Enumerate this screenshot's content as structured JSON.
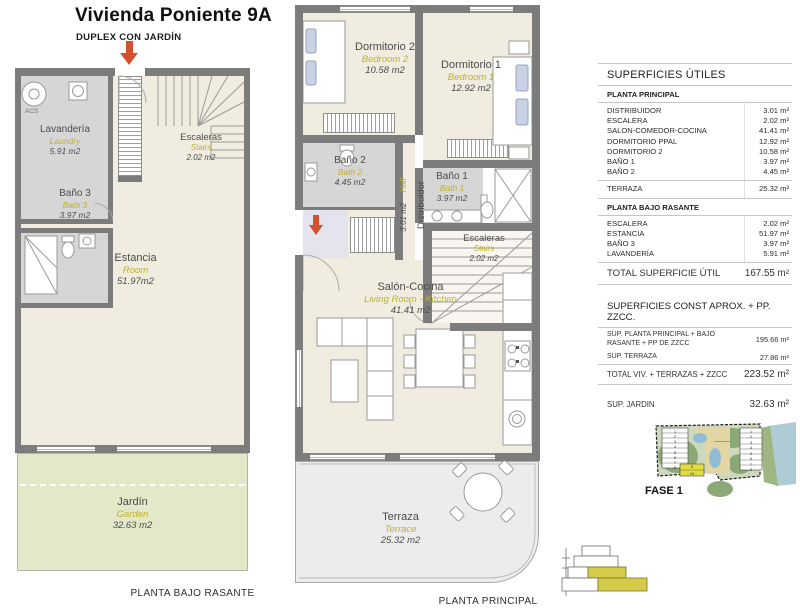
{
  "title": "Vivienda Poniente 9A",
  "subtitle": "DUPLEX CON JARDÍN",
  "plans": {
    "lower": {
      "caption": "PLANTA BAJO RASANTE",
      "acs": "ACS",
      "rooms": {
        "lavanderia": {
          "name": "Lavandería",
          "en": "Laundry",
          "area": "5.91 m2"
        },
        "escaleras": {
          "name": "Escaleras",
          "en": "Stairs",
          "area": "2.02 m2"
        },
        "bano3": {
          "name": "Baño 3",
          "en": "Bath 3",
          "area": "3.97 m2"
        },
        "estancia": {
          "name": "Estancia",
          "en": "Room",
          "area": "51.97m2"
        },
        "jardin": {
          "name": "Jardín",
          "en": "Garden",
          "area": "32.63 m2"
        }
      }
    },
    "main": {
      "caption": "PLANTA PRINCIPAL",
      "rooms": {
        "dormitorio2": {
          "name": "Dormitorio 2",
          "en": "Bedroom 2",
          "area": "10.58 m2"
        },
        "dormitorio1": {
          "name": "Dormitorio 1",
          "en": "Bedroom 1",
          "area": "12.92 m2"
        },
        "bano2": {
          "name": "Baño 2",
          "en": "Bath 2",
          "area": "4.45 m2"
        },
        "bano1": {
          "name": "Baño 1",
          "en": "Bath 1",
          "area": "3.97 m2"
        },
        "distribuidor": {
          "name": "Distribuidor",
          "en": "Hall",
          "area": "3.01 m2"
        },
        "escaleras": {
          "name": "Escaleras",
          "en": "Stairs",
          "area": "2.02 m2"
        },
        "salon": {
          "name": "Salón-Cocina",
          "en": "Living Room - Kitchen",
          "area": "41.41 m2"
        },
        "terraza": {
          "name": "Terraza",
          "en": "Terrace",
          "area": "25.32 m2"
        }
      }
    }
  },
  "surfaces_utiles": {
    "title": "SUPERFICIES ÚTILES",
    "sections": [
      {
        "heading": "PLANTA PRINCIPAL",
        "rows": [
          {
            "label": "DISTRIBUIDOR",
            "value": "3.01 m²"
          },
          {
            "label": "ESCALERA",
            "value": "2.02 m²"
          },
          {
            "label": "SALON-COMEDOR-COCINA",
            "value": "41.41 m²"
          },
          {
            "label": "DORMITORIO PPAL",
            "value": "12.92 m²"
          },
          {
            "label": "DORMITORIO 2",
            "value": "10.58 m²"
          },
          {
            "label": "BAÑO 1",
            "value": "3.97 m²"
          },
          {
            "label": "BAÑO 2",
            "value": "4.45 m²"
          }
        ],
        "terraza_row": {
          "label": "TERRAZA",
          "value": "25.32 m²"
        }
      },
      {
        "heading": "PLANTA BAJO RASANTE",
        "rows": [
          {
            "label": "ESCALERA",
            "value": "2.02 m²"
          },
          {
            "label": "ESTANCIA",
            "value": "51.97 m²"
          },
          {
            "label": "BAÑO 3",
            "value": "3.97 m²"
          },
          {
            "label": "LAVANDERÍA",
            "value": "5.91 m²"
          }
        ]
      }
    ],
    "total": {
      "label": "TOTAL SUPERFICIE ÚTIL",
      "value": "167.55 m²"
    }
  },
  "surfaces_const": {
    "title": "SUPERFICIES CONST APROX. + PP. ZZCC.",
    "rows": [
      {
        "label": "SUP. PLANTA PRINCIPAL + BAJO RASANTE + PP DE ZZCC",
        "value": "195.66 m²"
      },
      {
        "label": "SUP. TERRAZA",
        "value": "27.86 m²"
      }
    ],
    "total": {
      "label": "TOTAL VIV. + TERRAZAS + ZZCC",
      "value": "223.52 m²"
    },
    "jardin": {
      "label": "SUP. JARDIN",
      "value": "32.63 m²"
    }
  },
  "site_plan": {
    "label": "FASE 1",
    "left_units": [
      "1",
      "2",
      "3",
      "4",
      "5",
      "6",
      "7",
      "8"
    ],
    "highlight_units": [
      "9",
      "10"
    ],
    "right_units": [
      "1",
      "2",
      "3",
      "4",
      "5",
      "6",
      "7",
      "8"
    ]
  },
  "colors": {
    "wall": "#7c7c7c",
    "floor": "#f0ecdf",
    "bath": "#d6d6d6",
    "garden": "#e3e9c8",
    "terrace": "#ececec",
    "accent_yellow": "#bfb12e",
    "arrow_red": "#d4502a",
    "highlight": "#ddd64a"
  }
}
